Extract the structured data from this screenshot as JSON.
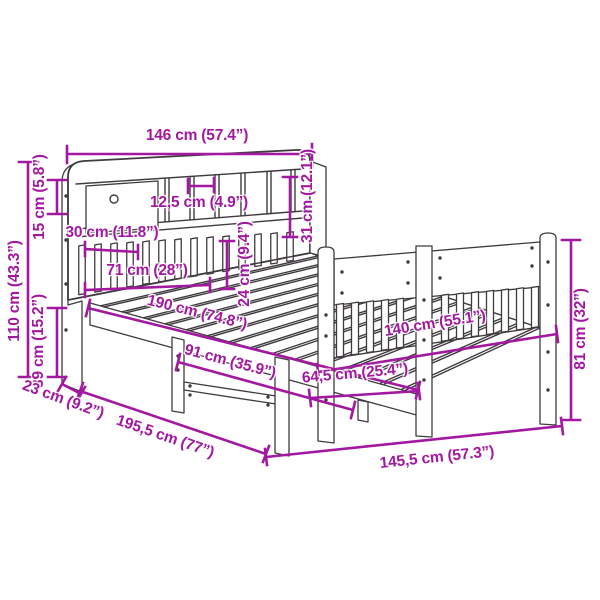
{
  "meta": {
    "title": "Bed frame with bookcase headboard – dimension diagram"
  },
  "colors": {
    "dimension": "#a318a0",
    "line_art": "#403b40",
    "background": "#ffffff"
  },
  "diagram": {
    "type": "product-dimension-diagram",
    "subject": "bed-frame-with-bookcase-headboard",
    "unit_format": "cm (inches)",
    "measurements": [
      {
        "id": "headboard-width",
        "label": "146 cm (57.4”)",
        "cm": 146,
        "inch": 57.4
      },
      {
        "id": "total-height",
        "label": "110 cm (43.3”)",
        "cm": 110,
        "inch": 43.3
      },
      {
        "id": "shelf-row-height",
        "label": "15 cm (5.8”)",
        "cm": 15,
        "inch": 5.8
      },
      {
        "id": "base-height",
        "label": "39 cm (15.2”)",
        "cm": 39,
        "inch": 15.2
      },
      {
        "id": "compartment-width",
        "label": "12,5 cm (4.9”)",
        "cm": 12.5,
        "inch": 4.9
      },
      {
        "id": "opening-width-30",
        "label": "30 cm (11.8”)",
        "cm": 30,
        "inch": 11.8
      },
      {
        "id": "opening-width-71",
        "label": "71 cm (28”)",
        "cm": 71,
        "inch": 28
      },
      {
        "id": "lower-rail-height-24",
        "label": "24 cm (9.4”)",
        "cm": 24,
        "inch": 9.4
      },
      {
        "id": "side-shelf-height-31",
        "label": "31 cm (12.1”)",
        "cm": 31,
        "inch": 12.1
      },
      {
        "id": "inner-length-190",
        "label": "190 cm (74.8”)",
        "cm": 190,
        "inch": 74.8
      },
      {
        "id": "support-spacing-91",
        "label": "91 cm (35.9”)",
        "cm": 91,
        "inch": 35.9
      },
      {
        "id": "headboard-depth-23",
        "label": "23 cm (9.2”)",
        "cm": 23,
        "inch": 9.2
      },
      {
        "id": "total-length-195",
        "label": "195,5 cm (77”)",
        "cm": 195.5,
        "inch": 77
      },
      {
        "id": "inner-width-140",
        "label": "140 cm (55.1”)",
        "cm": 140,
        "inch": 55.1
      },
      {
        "id": "post-spacing-64",
        "label": "64,5 cm (25.4”)",
        "cm": 64.5,
        "inch": 25.4
      },
      {
        "id": "footboard-height-81",
        "label": "81 cm (32”)",
        "cm": 81,
        "inch": 32
      },
      {
        "id": "total-width-145",
        "label": "145,5 cm (57.3”)",
        "cm": 145.5,
        "inch": 57.3
      }
    ]
  }
}
